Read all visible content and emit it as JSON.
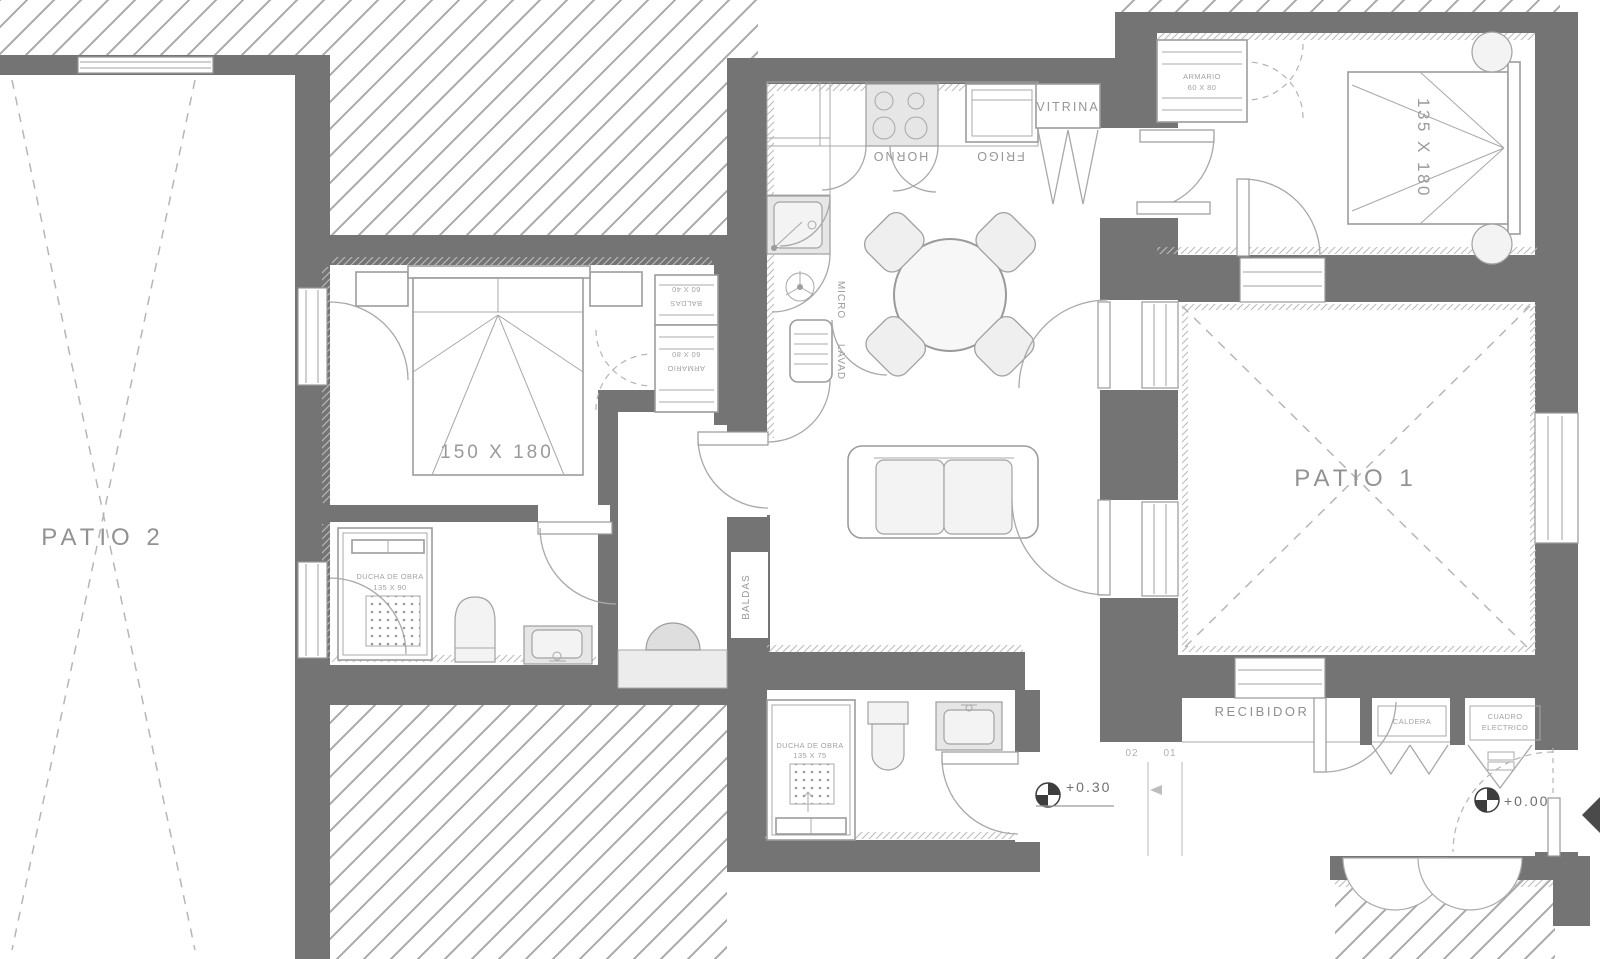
{
  "colors": {
    "wall": "#747474",
    "hatch_line": "#a9a9a9",
    "outline": "#9c9c9c",
    "label_text": "#929292",
    "marker_dark": "#3d3d3d",
    "appliance_fill": "#e6e6e6"
  },
  "rooms": {
    "patio1": {
      "label": "PATIO 1"
    },
    "patio2": {
      "label": "PATIO 2"
    },
    "recibidor": {
      "label": "RECIBIDOR"
    }
  },
  "bedroom_main": {
    "bed_label": "150 X 180",
    "wardrobe": {
      "shelf_dims": "60 X 40",
      "shelf_label": "BALDAS",
      "closet_dims": "60 X 80",
      "closet_label": "ARMARIO"
    }
  },
  "bedroom_second": {
    "bed_label": "135 X 180",
    "closet_label": "ARMARIO",
    "closet_dims": "60 X 80"
  },
  "kitchen": {
    "vitrina": "VITRINA",
    "horno": "HORNO",
    "frigo": "FRIGO",
    "micro": "MICRO",
    "lavadora": "LAVAD"
  },
  "hall": {
    "shelves": "BALDAS"
  },
  "bathroom_main": {
    "shower_line1": "DUCHA DE OBRA",
    "shower_line2": "135 X 90"
  },
  "bathroom_second": {
    "shower_line1": "DUCHA DE OBRA",
    "shower_line2": "135 X 75"
  },
  "utility": {
    "caldera": "CALDERA",
    "cuadro_line1": "CUADRO",
    "cuadro_line2": "ELECTRICO"
  },
  "levels": {
    "upper": "+0.30",
    "entry": "+0.00",
    "step_02": "02",
    "step_01": "01"
  }
}
